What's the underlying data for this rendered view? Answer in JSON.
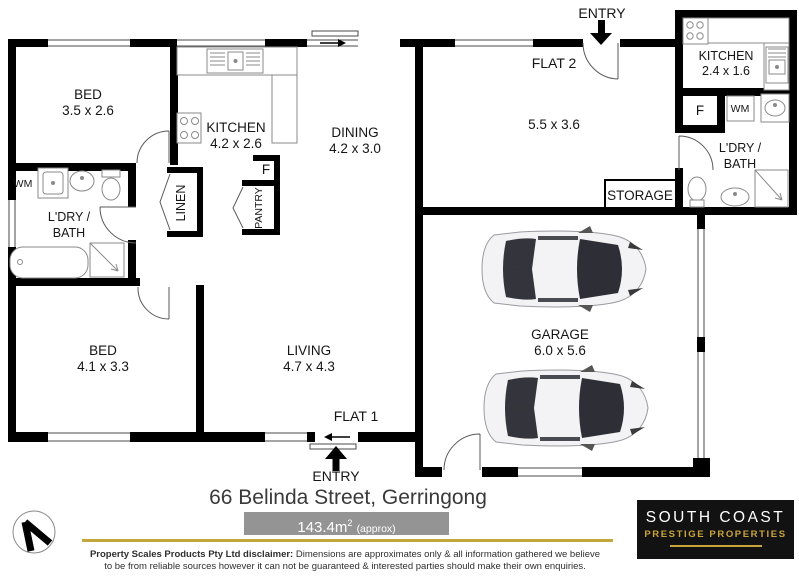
{
  "plan": {
    "flat1": {
      "bed1": {
        "label": "BED",
        "dims": "3.5 x 2.6"
      },
      "kitchen": {
        "label": "KITCHEN",
        "dims": "4.2 x 2.6"
      },
      "dining": {
        "label": "DINING",
        "dims": "4.2 x 3.0"
      },
      "laundry_bath": {
        "line1": "L'DRY /",
        "line2": "BATH"
      },
      "wm": "WM",
      "linen": "LINEN",
      "fridge": "F",
      "pantry": "PANTRY",
      "bed2": {
        "label": "BED",
        "dims": "4.1 x 3.3"
      },
      "living": {
        "label": "LIVING",
        "dims": "4.7 x 4.3"
      },
      "flat_label": "FLAT 1",
      "entry": "ENTRY"
    },
    "flat2": {
      "flat_label": "FLAT 2",
      "entry": "ENTRY",
      "room_dims": "5.5 x 3.6",
      "kitchen": {
        "label": "KITCHEN",
        "dims": "2.4 x 1.6"
      },
      "fridge": "F",
      "wm": "WM",
      "laundry_bath": {
        "line1": "L'DRY /",
        "line2": "BATH"
      },
      "storage": "STORAGE"
    },
    "garage": {
      "label": "GARAGE",
      "dims": "6.0 x 5.6"
    }
  },
  "footer": {
    "address": "66 Belinda Street, Gerringong",
    "area": {
      "value": "143.4m",
      "sup": "2",
      "approx": "(approx)"
    },
    "disclaimer": {
      "bold": "Property Scales Products Pty Ltd disclaimer:",
      "text": "Dimensions are approximates only & all information gathered we believe to be from reliable sources however it can not be guaranteed & interested parties should make their own enquiries."
    },
    "agency": {
      "line1": "SOUTH COAST",
      "line2": "PRESTIGE PROPERTIES"
    }
  },
  "colors": {
    "wall": "#000000",
    "gold": "#C4A63F",
    "area_bar": "#949494",
    "logo_bg": "#121212",
    "logo_gold": "#C9A43B"
  }
}
